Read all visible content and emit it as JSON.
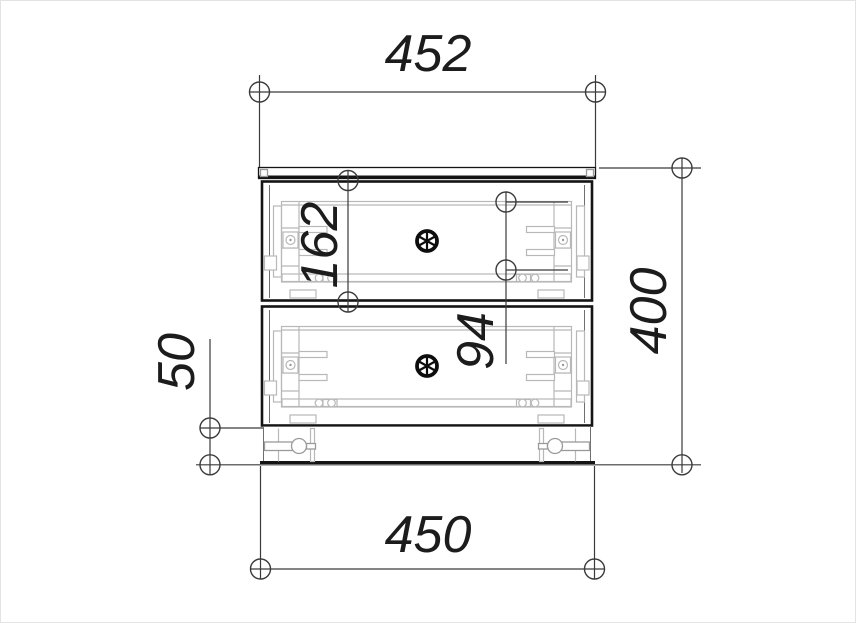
{
  "dimensions": {
    "top_width": "452",
    "bottom_width": "450",
    "overall_height": "400",
    "drawer_front_height": "162",
    "handle_pitch": "94",
    "plinth_height": "50"
  },
  "icons": {
    "drawer_knob": "spoked-wheel",
    "dimension_endpoint": "circle-marker"
  },
  "colors": {
    "background": "#ffffff",
    "outline": "#141414",
    "dimension_lines": "#3a3a3a",
    "hardware_detail": "#b8b8b8",
    "text": "#1c1c1c"
  }
}
